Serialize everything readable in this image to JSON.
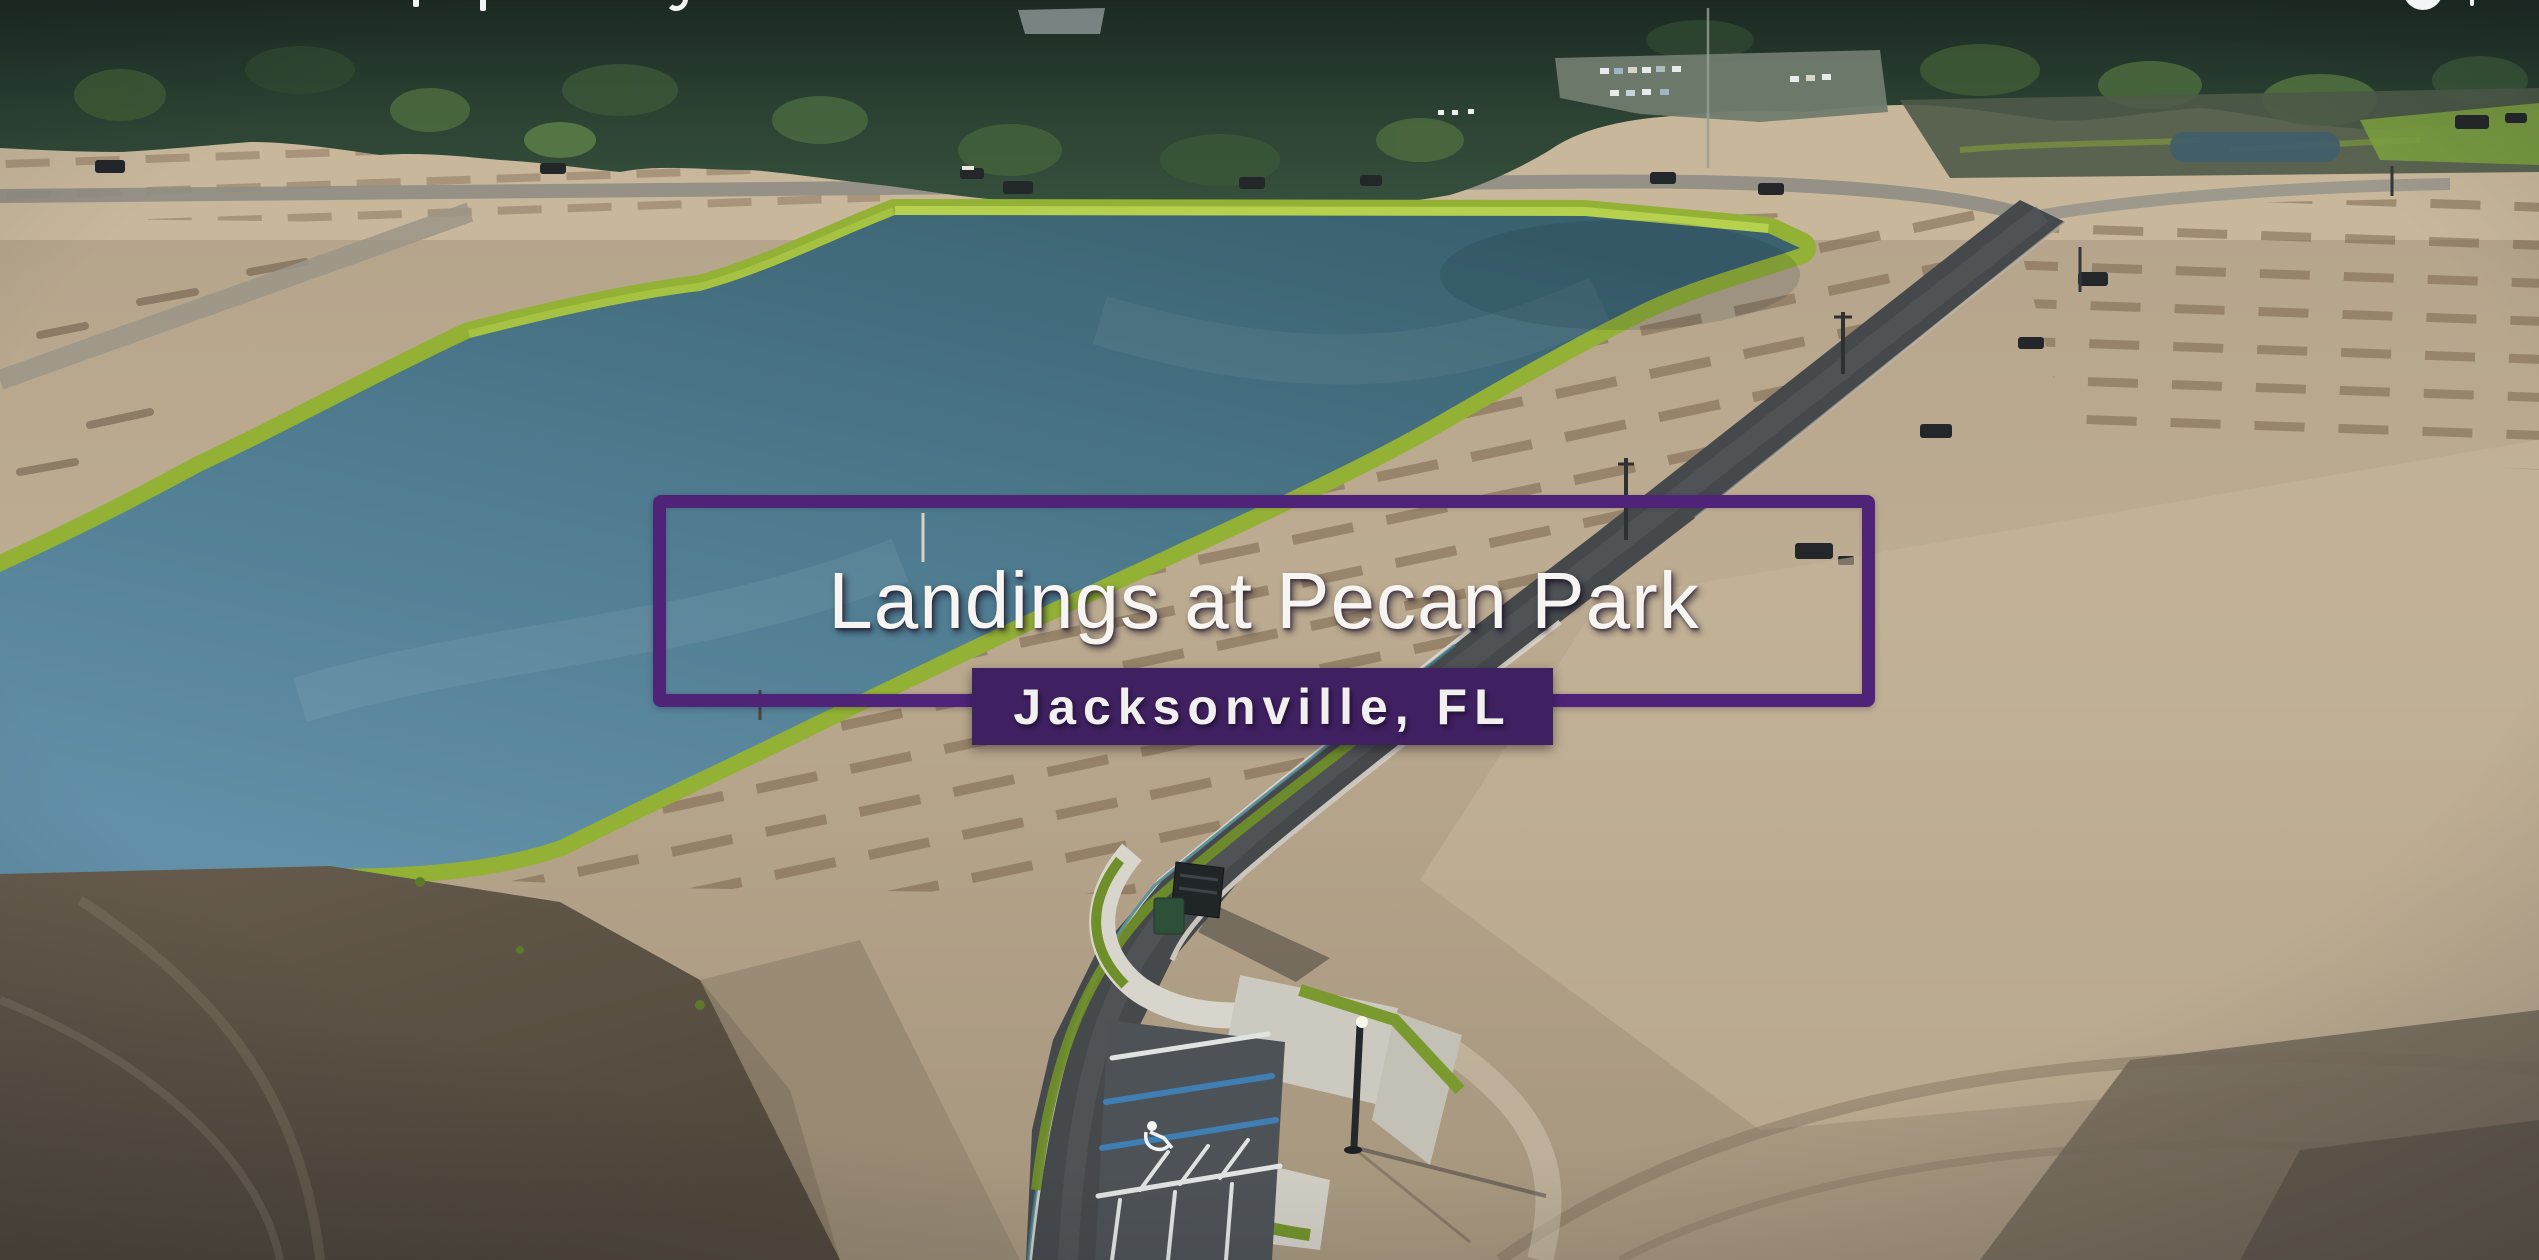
{
  "overlay": {
    "title": "Landings at Pecan Park",
    "location": "Jacksonville, FL"
  },
  "cutoff_ui": {
    "note": "white letter descenders and a circular icon from an overlay line cropped at the top edge of the frame"
  },
  "scene": {
    "description": "Aerial drone photo of a residential community under construction: large retention pond edged with bright green grass, graded sandy home lots with rows of dark soil furrows, a new curving asphalt road, amenity parking area with striped stalls, mail kiosk and sidewalks, pine treeline on the horizon with a distant parking lot of cars",
    "colors": {
      "title_border_purple": "#4f2478",
      "badge_purple": "#3f2060",
      "title_text": "#f7f5f1",
      "pond_water": "#4e7b90",
      "grass_bank": "#95b233",
      "sand": "#b7a78d",
      "asphalt_road": "#46494c",
      "treeline": "#2c4233",
      "dark_dirt": "#5f5446"
    }
  }
}
